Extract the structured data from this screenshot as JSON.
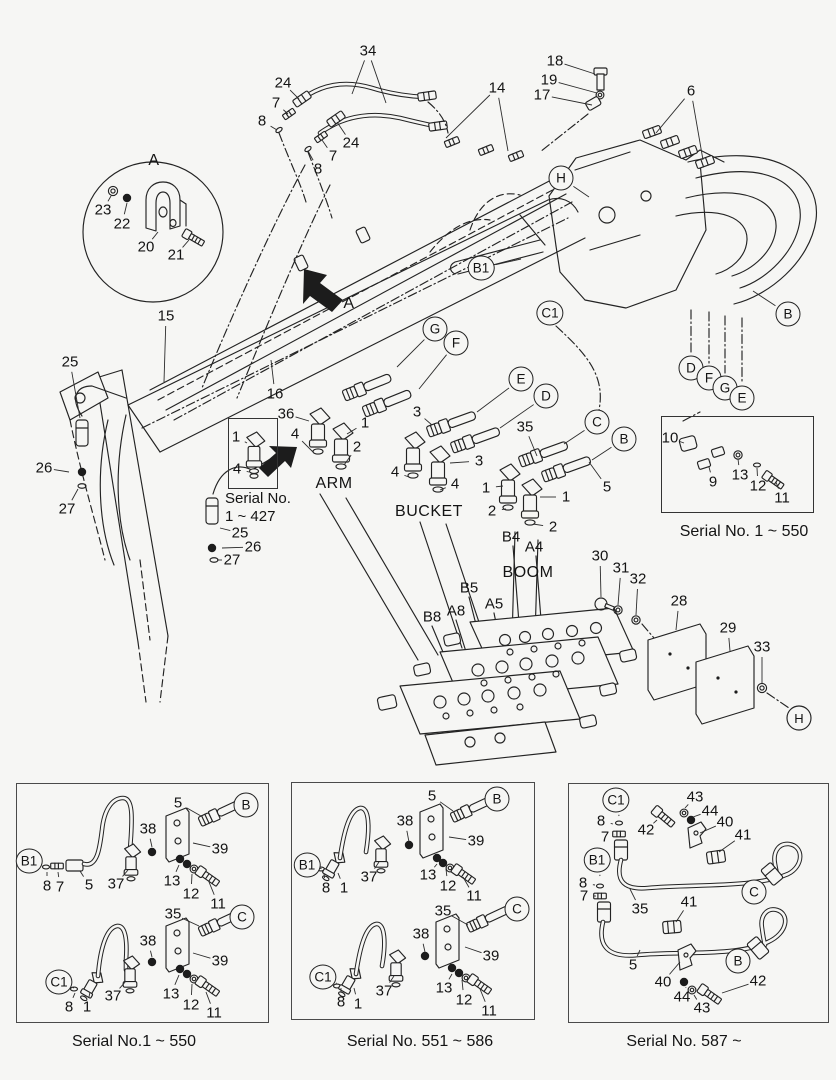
{
  "colors": {
    "background": "#f6f6f4",
    "line": "#232323",
    "text": "#141414"
  },
  "insets": {
    "s427": {
      "caption_line1": "Serial No.",
      "caption_line2": "1 ~ 427"
    },
    "s550": {
      "caption": "Serial No. 1 ~ 550"
    }
  },
  "panels": [
    {
      "caption": "Serial No.1 ~ 550"
    },
    {
      "caption": "Serial No. 551 ~ 586"
    },
    {
      "caption": "Serial No. 587 ~"
    }
  ],
  "callouts": [
    {
      "t": "34",
      "x": 368,
      "y": 51,
      "l": [
        [
          352,
          94
        ],
        [
          386,
          103
        ]
      ]
    },
    {
      "t": "24",
      "x": 283,
      "y": 83,
      "l": [
        [
          299,
          99
        ]
      ]
    },
    {
      "t": "7",
      "x": 276,
      "y": 103,
      "l": [
        [
          288,
          114
        ]
      ]
    },
    {
      "t": "8",
      "x": 262,
      "y": 121,
      "l": [
        [
          277,
          130
        ]
      ]
    },
    {
      "t": "24",
      "x": 351,
      "y": 143,
      "l": [
        [
          337,
          122
        ]
      ]
    },
    {
      "t": "7",
      "x": 333,
      "y": 156,
      "l": [
        [
          322,
          140
        ]
      ]
    },
    {
      "t": "8",
      "x": 318,
      "y": 169,
      "l": [
        [
          308,
          151
        ]
      ]
    },
    {
      "t": "18",
      "x": 555,
      "y": 61,
      "l": [
        [
          595,
          74
        ]
      ]
    },
    {
      "t": "19",
      "x": 549,
      "y": 80,
      "l": [
        [
          597,
          93
        ]
      ]
    },
    {
      "t": "17",
      "x": 542,
      "y": 95,
      "l": [
        [
          592,
          105
        ]
      ]
    },
    {
      "t": "14",
      "x": 497,
      "y": 88,
      "l": [
        [
          446,
          138
        ],
        [
          508,
          151
        ]
      ]
    },
    {
      "t": "6",
      "x": 691,
      "y": 91,
      "l": [
        [
          656,
          133
        ],
        [
          703,
          160
        ]
      ]
    },
    {
      "t": "23",
      "x": 103,
      "y": 210,
      "l": [
        [
          111,
          196
        ]
      ]
    },
    {
      "t": "22",
      "x": 122,
      "y": 224,
      "l": [
        [
          127,
          203
        ]
      ]
    },
    {
      "t": "20",
      "x": 146,
      "y": 247,
      "l": [
        [
          158,
          232
        ]
      ]
    },
    {
      "t": "21",
      "x": 176,
      "y": 255,
      "l": [
        [
          189,
          240
        ]
      ]
    },
    {
      "t": "A",
      "x": 154,
      "y": 161,
      "k": "t"
    },
    {
      "t": "A",
      "x": 349,
      "y": 304,
      "k": "t"
    },
    {
      "t": "15",
      "x": 166,
      "y": 316,
      "l": [
        [
          164,
          382
        ]
      ]
    },
    {
      "t": "25",
      "x": 70,
      "y": 362,
      "l": [
        [
          80,
          418
        ]
      ]
    },
    {
      "t": "26",
      "x": 44,
      "y": 468,
      "l": [
        [
          69,
          472
        ]
      ]
    },
    {
      "t": "27",
      "x": 67,
      "y": 509,
      "l": [
        [
          78,
          489
        ]
      ]
    },
    {
      "t": "16",
      "x": 275,
      "y": 394,
      "l": [
        [
          271,
          360
        ]
      ]
    },
    {
      "t": "25",
      "x": 240,
      "y": 533,
      "l": [
        [
          220,
          528
        ]
      ]
    },
    {
      "t": "26",
      "x": 253,
      "y": 547,
      "l": [
        [
          222,
          548
        ]
      ]
    },
    {
      "t": "27",
      "x": 232,
      "y": 560,
      "l": [
        [
          217,
          560
        ]
      ]
    },
    {
      "t": "36",
      "x": 286,
      "y": 414,
      "l": [
        [
          309,
          421
        ]
      ]
    },
    {
      "t": "4",
      "x": 295,
      "y": 434,
      "l": [
        [
          313,
          452
        ]
      ]
    },
    {
      "t": "1",
      "x": 365,
      "y": 423,
      "l": [
        [
          347,
          434
        ]
      ]
    },
    {
      "t": "2",
      "x": 357,
      "y": 447,
      "l": [
        [
          344,
          465
        ]
      ]
    },
    {
      "t": "3",
      "x": 417,
      "y": 412,
      "l": [
        [
          432,
          425
        ]
      ]
    },
    {
      "t": "3",
      "x": 479,
      "y": 461,
      "l": [
        [
          450,
          463
        ]
      ]
    },
    {
      "t": "4",
      "x": 395,
      "y": 472,
      "l": [
        [
          409,
          477
        ]
      ]
    },
    {
      "t": "4",
      "x": 455,
      "y": 484,
      "l": [
        [
          440,
          490
        ]
      ]
    },
    {
      "t": "35",
      "x": 525,
      "y": 427,
      "l": [
        [
          537,
          456
        ]
      ]
    },
    {
      "t": "1",
      "x": 486,
      "y": 488,
      "l": [
        [
          503,
          486
        ]
      ]
    },
    {
      "t": "2",
      "x": 492,
      "y": 511,
      "l": [
        [
          506,
          509
        ]
      ]
    },
    {
      "t": "1",
      "x": 566,
      "y": 497,
      "l": [
        [
          540,
          497
        ]
      ]
    },
    {
      "t": "2",
      "x": 553,
      "y": 527,
      "l": [
        [
          533,
          524
        ]
      ]
    },
    {
      "t": "5",
      "x": 607,
      "y": 487,
      "l": [
        [
          589,
          462
        ]
      ]
    },
    {
      "t": "B4",
      "x": 511,
      "y": 537
    },
    {
      "t": "A4",
      "x": 534,
      "y": 547
    },
    {
      "t": "B5",
      "x": 469,
      "y": 588
    },
    {
      "t": "A5",
      "x": 494,
      "y": 604
    },
    {
      "t": "B8",
      "x": 432,
      "y": 617
    },
    {
      "t": "A8",
      "x": 456,
      "y": 611
    },
    {
      "t": "30",
      "x": 600,
      "y": 556,
      "l": [
        [
          601,
          597
        ]
      ]
    },
    {
      "t": "31",
      "x": 621,
      "y": 568,
      "l": [
        [
          618,
          605
        ]
      ]
    },
    {
      "t": "32",
      "x": 638,
      "y": 579,
      "l": [
        [
          636,
          615
        ]
      ]
    },
    {
      "t": "28",
      "x": 679,
      "y": 601,
      "l": [
        [
          676,
          630
        ]
      ]
    },
    {
      "t": "29",
      "x": 728,
      "y": 628,
      "l": [
        [
          730,
          651
        ]
      ]
    },
    {
      "t": "33",
      "x": 762,
      "y": 647,
      "l": [
        [
          762,
          683
        ]
      ]
    },
    {
      "t": "H",
      "x": 561,
      "y": 178,
      "k": "c",
      "l": [
        [
          589,
          197
        ]
      ]
    },
    {
      "t": "B1",
      "x": 481,
      "y": 268,
      "k": "c",
      "l": [
        [
          521,
          259
        ]
      ]
    },
    {
      "t": "C1",
      "x": 550,
      "y": 313,
      "k": "c"
    },
    {
      "t": "B",
      "x": 788,
      "y": 314,
      "k": "c",
      "l": [
        [
          753,
          291
        ]
      ]
    },
    {
      "t": "D",
      "x": 691,
      "y": 368,
      "k": "c"
    },
    {
      "t": "F",
      "x": 709,
      "y": 378,
      "k": "c"
    },
    {
      "t": "G",
      "x": 725,
      "y": 388,
      "k": "c"
    },
    {
      "t": "E",
      "x": 742,
      "y": 398,
      "k": "c"
    },
    {
      "t": "G",
      "x": 435,
      "y": 329,
      "k": "c",
      "l": [
        [
          397,
          367
        ]
      ]
    },
    {
      "t": "F",
      "x": 456,
      "y": 343,
      "k": "c",
      "l": [
        [
          419,
          389
        ]
      ]
    },
    {
      "t": "E",
      "x": 521,
      "y": 379,
      "k": "c",
      "l": [
        [
          477,
          412
        ]
      ]
    },
    {
      "t": "D",
      "x": 546,
      "y": 396,
      "k": "c",
      "l": [
        [
          500,
          428
        ]
      ]
    },
    {
      "t": "C",
      "x": 597,
      "y": 422,
      "k": "c",
      "l": [
        [
          564,
          444
        ]
      ]
    },
    {
      "t": "B",
      "x": 624,
      "y": 439,
      "k": "c",
      "l": [
        [
          592,
          460
        ]
      ]
    },
    {
      "t": "ARM",
      "x": 334,
      "y": 484,
      "k": "t"
    },
    {
      "t": "BUCKET",
      "x": 429,
      "y": 512,
      "k": "t"
    },
    {
      "t": "BOOM",
      "x": 528,
      "y": 573,
      "k": "t"
    },
    {
      "t": "1",
      "x": 236,
      "y": 437,
      "l": [
        [
          247,
          443
        ]
      ]
    },
    {
      "t": "4",
      "x": 237,
      "y": 469,
      "l": [
        [
          249,
          472
        ]
      ]
    },
    {
      "t": "10",
      "x": 670,
      "y": 438,
      "l": [
        [
          684,
          443
        ]
      ]
    },
    {
      "t": "9",
      "x": 713,
      "y": 482,
      "l": [
        [
          709,
          467
        ]
      ]
    },
    {
      "t": "13",
      "x": 740,
      "y": 475,
      "l": [
        [
          738,
          459
        ]
      ]
    },
    {
      "t": "12",
      "x": 758,
      "y": 486,
      "l": [
        [
          757,
          468
        ]
      ]
    },
    {
      "t": "11",
      "x": 782,
      "y": 498,
      "l": [
        [
          776,
          482
        ]
      ]
    },
    {
      "t": "B",
      "x": 246,
      "y": 805,
      "k": "c"
    },
    {
      "t": "5",
      "x": 178,
      "y": 803,
      "l": [
        [
          201,
          816
        ]
      ]
    },
    {
      "t": "38",
      "x": 148,
      "y": 829,
      "l": [
        [
          152,
          847
        ]
      ]
    },
    {
      "t": "39",
      "x": 220,
      "y": 849,
      "l": [
        [
          193,
          843
        ]
      ]
    },
    {
      "t": "B1",
      "x": 29,
      "y": 861,
      "k": "c",
      "l": [
        [
          42,
          866
        ]
      ]
    },
    {
      "t": "8",
      "x": 47,
      "y": 886,
      "l": [
        [
          47,
          872
        ]
      ]
    },
    {
      "t": "7",
      "x": 60,
      "y": 887,
      "l": [
        [
          58,
          872
        ]
      ]
    },
    {
      "t": "5",
      "x": 89,
      "y": 885,
      "l": [
        [
          80,
          871
        ]
      ]
    },
    {
      "t": "37",
      "x": 116,
      "y": 884,
      "l": [
        [
          128,
          870
        ]
      ]
    },
    {
      "t": "13",
      "x": 172,
      "y": 881,
      "l": [
        [
          179,
          865
        ]
      ]
    },
    {
      "t": "12",
      "x": 191,
      "y": 894,
      "l": [
        [
          192,
          874
        ]
      ]
    },
    {
      "t": "11",
      "x": 218,
      "y": 904,
      "l": [
        [
          209,
          882
        ]
      ]
    },
    {
      "t": "35",
      "x": 173,
      "y": 914,
      "l": [
        [
          199,
          926
        ]
      ]
    },
    {
      "t": "C",
      "x": 242,
      "y": 917,
      "k": "c"
    },
    {
      "t": "38",
      "x": 148,
      "y": 941,
      "l": [
        [
          152,
          957
        ]
      ]
    },
    {
      "t": "39",
      "x": 220,
      "y": 961,
      "l": [
        [
          193,
          953
        ]
      ]
    },
    {
      "t": "C1",
      "x": 59,
      "y": 982,
      "k": "c",
      "l": [
        [
          74,
          988
        ]
      ]
    },
    {
      "t": "8",
      "x": 69,
      "y": 1007,
      "l": [
        [
          75,
          993
        ]
      ]
    },
    {
      "t": "1",
      "x": 87,
      "y": 1007,
      "l": [
        [
          90,
          992
        ]
      ]
    },
    {
      "t": "37",
      "x": 113,
      "y": 996,
      "l": [
        [
          126,
          981
        ]
      ]
    },
    {
      "t": "13",
      "x": 171,
      "y": 994,
      "l": [
        [
          179,
          975
        ]
      ]
    },
    {
      "t": "12",
      "x": 191,
      "y": 1005,
      "l": [
        [
          192,
          984
        ]
      ]
    },
    {
      "t": "11",
      "x": 214,
      "y": 1013,
      "l": [
        [
          206,
          992
        ]
      ]
    },
    {
      "t": "5",
      "x": 432,
      "y": 796,
      "l": [
        [
          453,
          811
        ]
      ]
    },
    {
      "t": "B",
      "x": 497,
      "y": 799,
      "k": "c"
    },
    {
      "t": "38",
      "x": 405,
      "y": 821,
      "l": [
        [
          409,
          842
        ]
      ]
    },
    {
      "t": "39",
      "x": 476,
      "y": 841,
      "l": [
        [
          449,
          837
        ]
      ]
    },
    {
      "t": "B1",
      "x": 307,
      "y": 865,
      "k": "c",
      "l": [
        [
          319,
          868
        ]
      ]
    },
    {
      "t": "8",
      "x": 326,
      "y": 888,
      "l": [
        [
          324,
          874
        ]
      ]
    },
    {
      "t": "1",
      "x": 344,
      "y": 888,
      "l": [
        [
          338,
          873
        ]
      ]
    },
    {
      "t": "37",
      "x": 369,
      "y": 877,
      "l": [
        [
          379,
          862
        ]
      ]
    },
    {
      "t": "13",
      "x": 428,
      "y": 875,
      "l": [
        [
          437,
          864
        ]
      ]
    },
    {
      "t": "12",
      "x": 448,
      "y": 886,
      "l": [
        [
          446,
          869
        ]
      ]
    },
    {
      "t": "11",
      "x": 474,
      "y": 896,
      "l": [
        [
          463,
          877
        ]
      ]
    },
    {
      "t": "35",
      "x": 443,
      "y": 911,
      "l": [
        [
          468,
          925
        ]
      ]
    },
    {
      "t": "C",
      "x": 517,
      "y": 909,
      "k": "c"
    },
    {
      "t": "38",
      "x": 421,
      "y": 934,
      "l": [
        [
          425,
          952
        ]
      ]
    },
    {
      "t": "39",
      "x": 491,
      "y": 956,
      "l": [
        [
          465,
          947
        ]
      ]
    },
    {
      "t": "C1",
      "x": 323,
      "y": 977,
      "k": "c",
      "l": [
        [
          336,
          983
        ]
      ]
    },
    {
      "t": "8",
      "x": 341,
      "y": 1002,
      "l": [
        [
          341,
          988
        ]
      ]
    },
    {
      "t": "1",
      "x": 358,
      "y": 1004,
      "l": [
        [
          354,
          988
        ]
      ]
    },
    {
      "t": "37",
      "x": 384,
      "y": 991,
      "l": [
        [
          394,
          976
        ]
      ]
    },
    {
      "t": "13",
      "x": 444,
      "y": 988,
      "l": [
        [
          452,
          974
        ]
      ]
    },
    {
      "t": "12",
      "x": 464,
      "y": 1000,
      "l": [
        [
          462,
          980
        ]
      ]
    },
    {
      "t": "11",
      "x": 489,
      "y": 1011,
      "l": [
        [
          480,
          989
        ]
      ]
    },
    {
      "t": "C1",
      "x": 616,
      "y": 800,
      "k": "c",
      "l": [
        [
          619,
          816
        ]
      ]
    },
    {
      "t": "8",
      "x": 601,
      "y": 821,
      "l": [
        [
          613,
          824
        ]
      ]
    },
    {
      "t": "7",
      "x": 605,
      "y": 837,
      "l": [
        [
          615,
          835
        ]
      ]
    },
    {
      "t": "42",
      "x": 646,
      "y": 830,
      "l": [
        [
          657,
          820
        ]
      ]
    },
    {
      "t": "43",
      "x": 695,
      "y": 797,
      "l": [
        [
          685,
          808
        ]
      ]
    },
    {
      "t": "44",
      "x": 710,
      "y": 811,
      "l": [
        [
          693,
          817
        ]
      ]
    },
    {
      "t": "40",
      "x": 725,
      "y": 822,
      "l": [
        [
          700,
          833
        ]
      ]
    },
    {
      "t": "41",
      "x": 743,
      "y": 835,
      "l": [
        [
          719,
          852
        ]
      ]
    },
    {
      "t": "B1",
      "x": 597,
      "y": 860,
      "k": "c",
      "l": [
        [
          600,
          876
        ]
      ]
    },
    {
      "t": "8",
      "x": 583,
      "y": 883,
      "l": [
        [
          595,
          885
        ]
      ]
    },
    {
      "t": "7",
      "x": 584,
      "y": 896,
      "l": [
        [
          596,
          896
        ]
      ]
    },
    {
      "t": "35",
      "x": 640,
      "y": 909,
      "l": [
        [
          630,
          889
        ]
      ]
    },
    {
      "t": "C",
      "x": 754,
      "y": 892,
      "k": "c"
    },
    {
      "t": "41",
      "x": 689,
      "y": 902,
      "l": [
        [
          676,
          922
        ]
      ]
    },
    {
      "t": "5",
      "x": 633,
      "y": 965,
      "l": [
        [
          640,
          950
        ]
      ]
    },
    {
      "t": "B",
      "x": 738,
      "y": 961,
      "k": "c"
    },
    {
      "t": "40",
      "x": 663,
      "y": 982,
      "l": [
        [
          680,
          962
        ]
      ]
    },
    {
      "t": "44",
      "x": 682,
      "y": 997,
      "l": [
        [
          686,
          987
        ]
      ]
    },
    {
      "t": "43",
      "x": 702,
      "y": 1008,
      "l": [
        [
          694,
          995
        ]
      ]
    },
    {
      "t": "42",
      "x": 758,
      "y": 981,
      "l": [
        [
          722,
          993
        ]
      ]
    }
  ]
}
